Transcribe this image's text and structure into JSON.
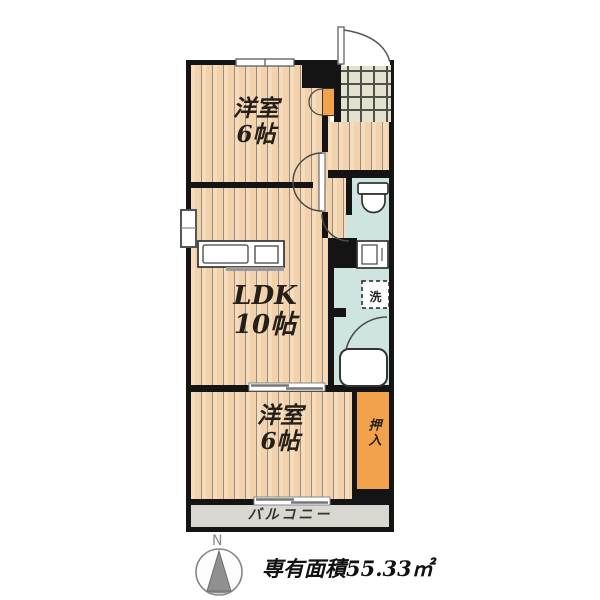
{
  "plan": {
    "rooms": [
      {
        "id": "bedroom-top",
        "name": "洋室",
        "size": "6帖"
      },
      {
        "id": "ldk",
        "name": "LDK",
        "size": "10帖"
      },
      {
        "id": "bedroom-bottom",
        "name": "洋室",
        "size": "6帖"
      }
    ],
    "closet_label": "押入",
    "balcony_label": "バルコニー",
    "laundry_label": "洗",
    "compass_label": "N",
    "area_caption": "専有面積55.33㎡",
    "colors": {
      "floor": "#f2d2ad",
      "wall": "#141414",
      "wet_area": "#cde4e1",
      "entrance_tile": "#e4e2cf",
      "closet": "#f2a24b",
      "balcony": "#d8d8d0"
    }
  }
}
